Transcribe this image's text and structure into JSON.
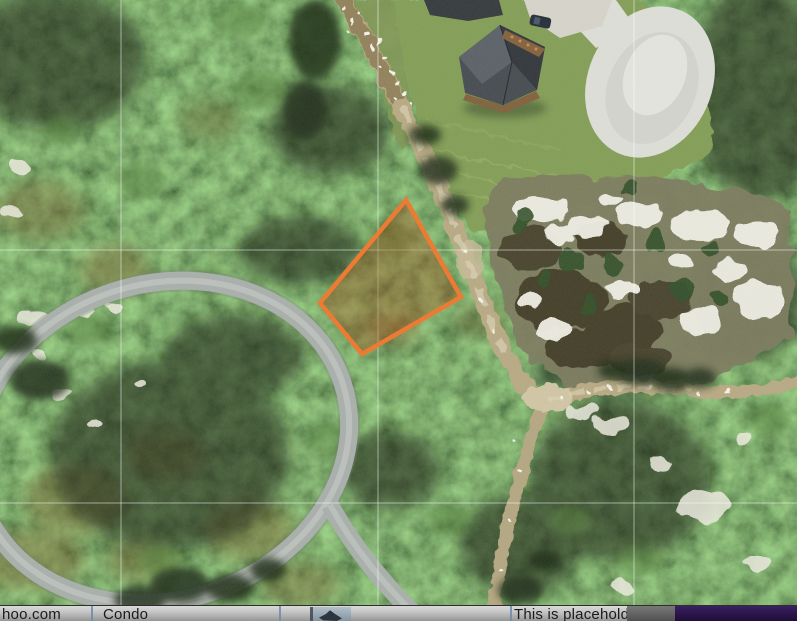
{
  "map": {
    "kind": "satellite-aerial-view",
    "features": [
      "forest",
      "house-with-driveway",
      "cul-de-sac",
      "dirt-road",
      "paved-loop-road",
      "sand-clearing",
      "highlighted-parcel"
    ],
    "parcel": {
      "outline_color": "#EB7226",
      "fill_color": "rgba(150,60,8,0.38)",
      "vertices": [
        [
          406,
          200
        ],
        [
          461,
          297
        ],
        [
          362,
          354
        ],
        [
          320,
          303
        ]
      ]
    },
    "gridlines": {
      "color": "#ffffff",
      "opacity": 0.5,
      "x": [
        121,
        378,
        634
      ],
      "y": [
        250,
        503
      ]
    }
  },
  "bottom_bar": {
    "email_text": "hoo.com",
    "type_text": "Condo",
    "note_text": "This is placehold",
    "divider_color": "#7089A6",
    "panel_color": "#2A1548",
    "divider_x": [
      91,
      279,
      510
    ]
  }
}
